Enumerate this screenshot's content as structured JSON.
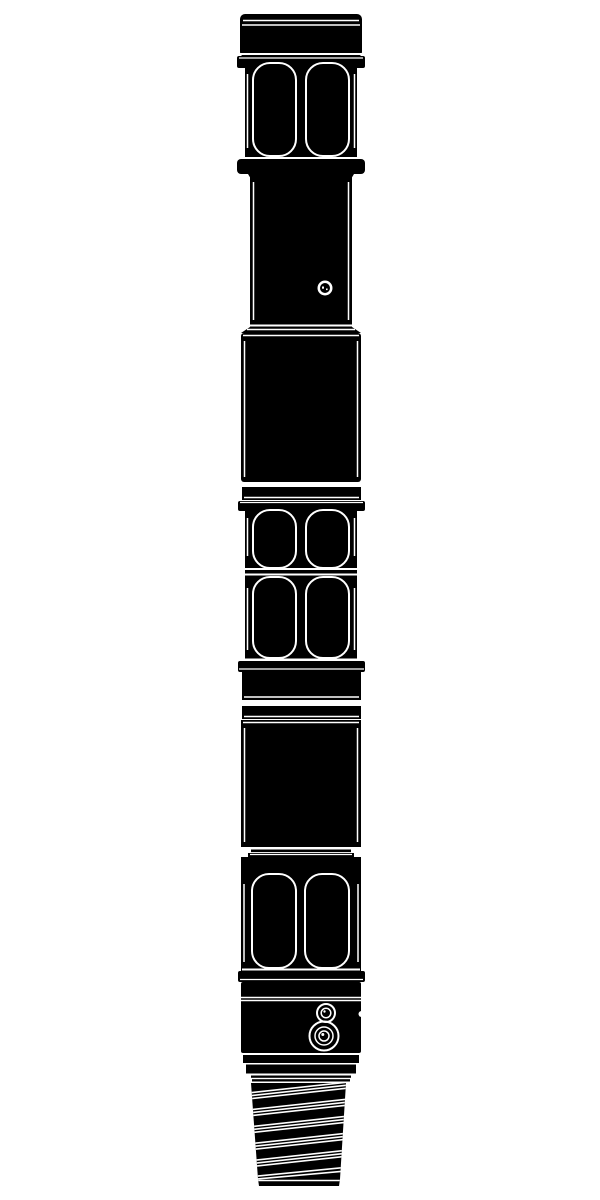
{
  "document": {
    "background_color": "#ffffff",
    "ink_color": "#000000",
    "line_color": "#ffffff",
    "orientation": "vertical",
    "description": "Black silhouette technical drawing of a downhole drilling tool assembly"
  },
  "illustration": {
    "parts": [
      {
        "id": "top-box-connection"
      },
      {
        "id": "top-wrench-flat-section"
      },
      {
        "id": "upper-mandrel"
      },
      {
        "id": "upper-housing"
      },
      {
        "id": "spacer-band-upper"
      },
      {
        "id": "mid-wrench-flat-section"
      },
      {
        "id": "spacer-band-lower"
      },
      {
        "id": "lower-housing"
      },
      {
        "id": "bottom-wrench-flat-section"
      },
      {
        "id": "ported-sub"
      },
      {
        "id": "pin-thread-connection"
      }
    ],
    "features": {
      "port_hole_count": 1,
      "concentric_port_count": 2,
      "thread_stripe_count": 6,
      "slot_pair_count": 4
    }
  }
}
